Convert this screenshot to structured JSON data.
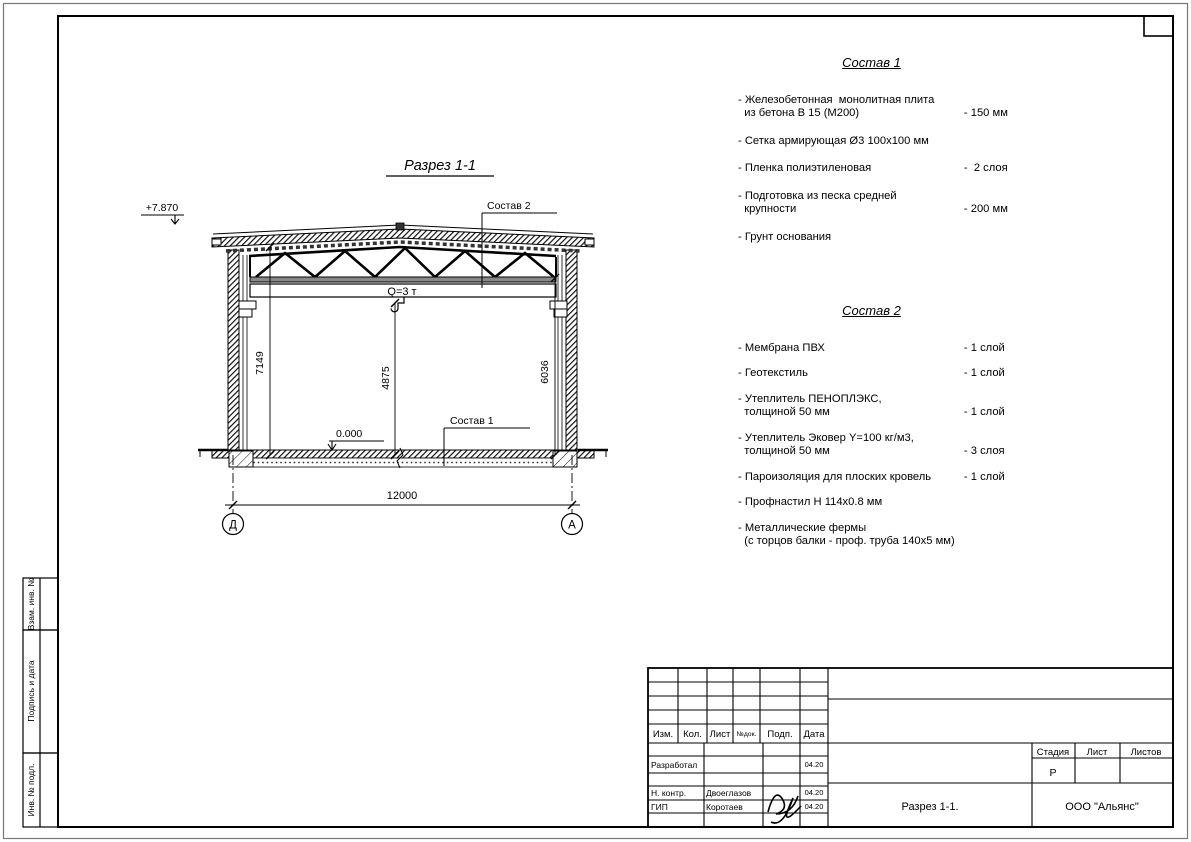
{
  "drawing": {
    "title": "Разрез 1-1",
    "elevation_top": "+7.870",
    "elevation_floor": "0.000",
    "crane_label": "Q=3 т",
    "dim_left": "7149",
    "dim_center": "4875",
    "dim_right": "6036",
    "dim_span": "12000",
    "axis_left": "Д",
    "axis_right": "А",
    "leader_sostav1": "Состав 1",
    "leader_sostav2": "Состав 2"
  },
  "sostav1": {
    "title": "Состав 1",
    "items": [
      {
        "name": "- Железобетонная  монолитная плита\n  из бетона В 15 (М200)",
        "value": "- 150 мм"
      },
      {
        "name": "- Сетка армирующая Ø3 100х100 мм",
        "value": ""
      },
      {
        "name": "- Пленка полиэтиленовая",
        "value": "-  2 слоя"
      },
      {
        "name": "- Подготовка из песка средней\n  крупности",
        "value": "- 200 мм"
      },
      {
        "name": "- Грунт основания",
        "value": ""
      }
    ]
  },
  "sostav2": {
    "title": "Состав 2",
    "items": [
      {
        "name": "- Мембрана ПВХ",
        "value": "- 1 слой"
      },
      {
        "name": "- Геотекстиль",
        "value": "- 1 слой"
      },
      {
        "name": "- Утеплитель ПЕНОПЛЭКС,\n  толщиной 50 мм",
        "value": "- 1 слой"
      },
      {
        "name": "- Утеплитель Эковер Y=100 кг/м3,\n  толщиной 50 мм",
        "value": "- 3 слоя"
      },
      {
        "name": "- Пароизоляция для плоских кровель",
        "value": "- 1 слой"
      },
      {
        "name": "- Профнастил Н 114х0.8 мм",
        "value": ""
      },
      {
        "name": "- Металлические фермы\n  (с торцов балки - проф. труба 140х5 мм)",
        "value": ""
      }
    ]
  },
  "stamp": {
    "header": [
      "Изм.",
      "Кол.",
      "Лист",
      "№док.",
      "Подп.",
      "Дата"
    ],
    "rows": {
      "developed": {
        "role": "Разработал",
        "name": "",
        "date": "04.20"
      },
      "ncontrol": {
        "role": "Н. контр.",
        "name": "Двоеглазов",
        "date": "04.20"
      },
      "gip": {
        "role": "ГИП",
        "name": "Коротаев",
        "date": "04.20"
      }
    },
    "stage_label": "Стадия",
    "sheet_label": "Лист",
    "sheets_label": "Листов",
    "stage_value": "Р",
    "doc_title": "Разрез 1-1.",
    "org": "ООО \"Альянс\""
  },
  "side_labels": [
    "Взам. инв. №",
    "Подпись и дата",
    "Инв. № подл."
  ]
}
